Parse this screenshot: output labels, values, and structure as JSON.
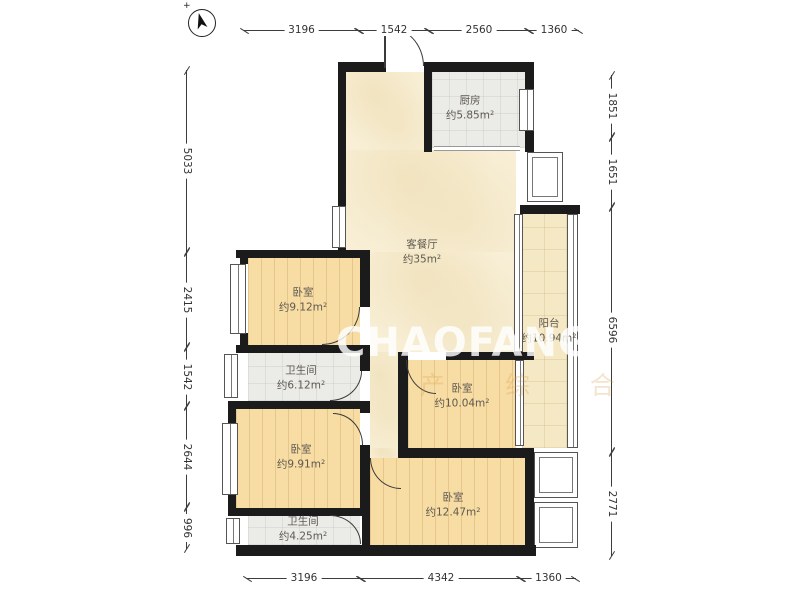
{
  "meta": {
    "type": "apartment-floor-plan",
    "colors": {
      "wall": "#1b1b1b",
      "wood_floor": "#f7dca4",
      "tile_floor": "#ebebe8",
      "living_floor": "#f8efd6",
      "balcony_floor": "#f5e8c5"
    }
  },
  "compass": {
    "label": "north-arrow",
    "plus": "+"
  },
  "watermark": {
    "main": "CHAOFANG",
    "sub": "产 综 合"
  },
  "rooms": [
    {
      "id": "kitchen",
      "name": "厨房",
      "area": "约5.85m²"
    },
    {
      "id": "living",
      "name": "客餐厅",
      "area": "约35m²"
    },
    {
      "id": "bedroom-tl",
      "name": "卧室",
      "area": "约9.12m²"
    },
    {
      "id": "bath-1",
      "name": "卫生间",
      "area": "约6.12m²"
    },
    {
      "id": "bedroom-mr",
      "name": "卧室",
      "area": "约10.04m²"
    },
    {
      "id": "balcony",
      "name": "阳台",
      "area": "约10.94m²"
    },
    {
      "id": "bedroom-bl",
      "name": "卧室",
      "area": "约9.91m²"
    },
    {
      "id": "bedroom-br",
      "name": "卧室",
      "area": "约12.47m²"
    },
    {
      "id": "bath-2",
      "name": "卫生间",
      "area": "约4.25m²"
    }
  ],
  "dimensions": {
    "top": [
      "3196",
      "1542",
      "2560",
      "1360"
    ],
    "bottom": [
      "3196",
      "4342",
      "1360"
    ],
    "left": [
      "5033",
      "2415",
      "1542",
      "2644",
      "996"
    ],
    "right": [
      "1851",
      "1651",
      "6596",
      "2771"
    ]
  }
}
